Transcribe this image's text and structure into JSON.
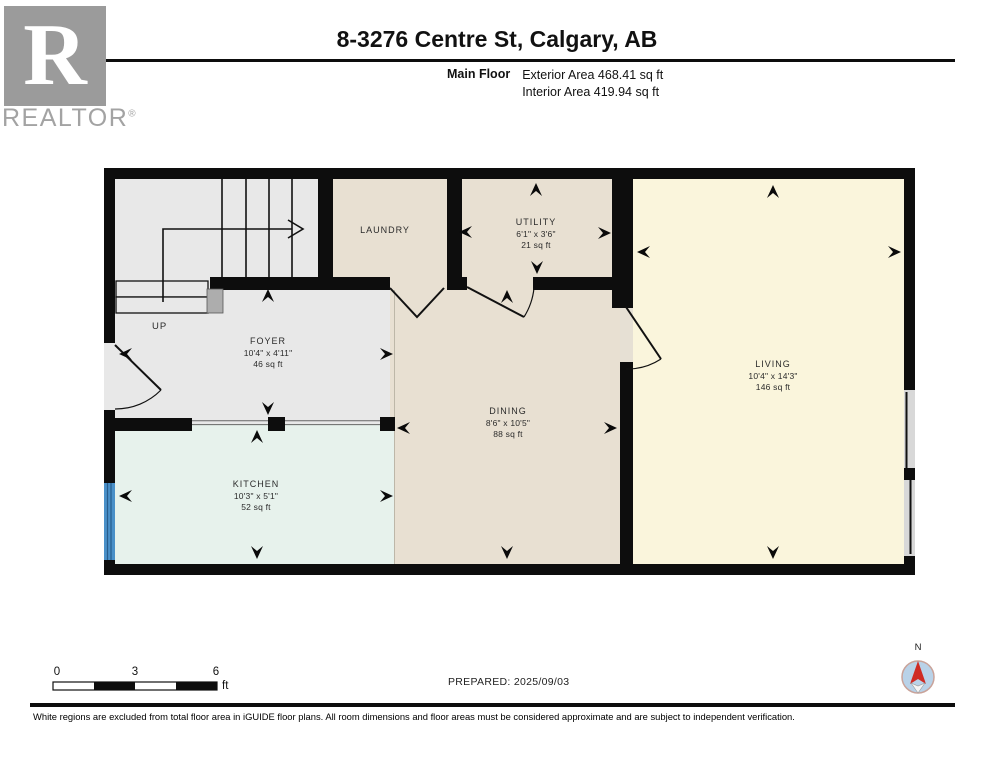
{
  "header": {
    "brand": {
      "logo_letter": "R",
      "brand_name": "REALTOR",
      "registered": "®"
    },
    "title": "8-3276 Centre St, Calgary, AB",
    "floor_label": "Main Floor",
    "exterior_area": "Exterior Area 468.41 sq ft",
    "interior_area": "Interior Area 419.94 sq ft"
  },
  "plan": {
    "stairs_label": "UP",
    "rooms": [
      {
        "id": "laundry",
        "name": "LAUNDRY",
        "dims": "",
        "area": ""
      },
      {
        "id": "utility",
        "name": "UTILITY",
        "dims": "6'1\" x 3'6\"",
        "area": "21 sq ft"
      },
      {
        "id": "foyer",
        "name": "FOYER",
        "dims": "10'4\" x 4'11\"",
        "area": "46 sq ft"
      },
      {
        "id": "dining",
        "name": "DINING",
        "dims": "8'6\" x 10'5\"",
        "area": "88 sq ft"
      },
      {
        "id": "kitchen",
        "name": "KITCHEN",
        "dims": "10'3\" x 5'1\"",
        "area": "52 sq ft"
      },
      {
        "id": "living",
        "name": "LIVING",
        "dims": "10'4\" x 14'3\"",
        "area": "146 sq ft"
      }
    ]
  },
  "scale_bar": {
    "tick0": "0",
    "tick3": "3",
    "tick6": "6",
    "unit": "ft"
  },
  "prepared": "PREPARED: 2025/09/03",
  "compass": {
    "north_label": "N"
  },
  "footer": "White regions are excluded from total floor area in iGUIDE floor plans. All room dimensions and floor areas must be considered approximate and are subject to independent verification.",
  "colors": {
    "wall": "#0d0d0d",
    "foyer_gray": "#e8e8e8",
    "beige": "#e8e0d2",
    "kitchen_mint": "#e7f2ec",
    "living_cream": "#faf5dc",
    "window_blue": "#4a90c8",
    "slider_gray": "#d8d8d8",
    "compass_blue": "#b9d2e8",
    "compass_red": "#cf2b24",
    "logo_gray": "#9b9b9b"
  }
}
